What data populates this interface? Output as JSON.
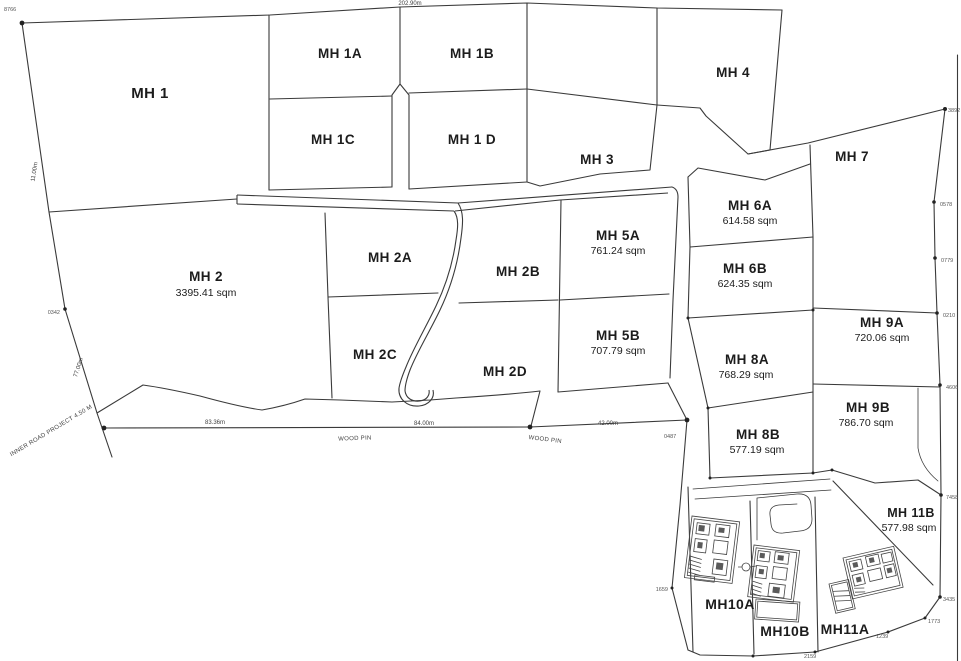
{
  "plots": [
    {
      "label": "MH 1"
    },
    {
      "label": "MH 1A"
    },
    {
      "label": "MH 1B"
    },
    {
      "label": "MH 1C"
    },
    {
      "label": "MH 1 D"
    },
    {
      "label": "MH 3"
    },
    {
      "label": "MH 4"
    },
    {
      "label": "MH 7"
    },
    {
      "label": "MH 2",
      "area": "3395.41 sqm"
    },
    {
      "label": "MH 2A"
    },
    {
      "label": "MH 2B"
    },
    {
      "label": "MH 2C"
    },
    {
      "label": "MH 2D"
    },
    {
      "label": "MH 5A",
      "area": "761.24 sqm"
    },
    {
      "label": "MH 5B",
      "area": "707.79 sqm"
    },
    {
      "label": "MH 6A",
      "area": "614.58 sqm"
    },
    {
      "label": "MH 6B",
      "area": "624.35 sqm"
    },
    {
      "label": "MH 8A",
      "area": "768.29 sqm"
    },
    {
      "label": "MH 8B",
      "area": "577.19 sqm"
    },
    {
      "label": "MH 9A",
      "area": "720.06 sqm"
    },
    {
      "label": "MH 9B",
      "area": "786.70 sqm"
    },
    {
      "label": "MH 11B",
      "area": "577.98 sqm"
    },
    {
      "label": "MH10A"
    },
    {
      "label": "MH10B"
    },
    {
      "label": "MH11A"
    }
  ],
  "dimensions": {
    "top_edge": "202.90m",
    "left_edge_upper": "11.00m",
    "left_edge_lower": "77.00m",
    "road_seg_1": "83.36m",
    "road_seg_2": "84.00m",
    "road_seg_3": "42.00m"
  },
  "road_labels": {
    "inner_road": "INNER ROAD PROJECT 4.50 M",
    "wood_pin_1": "WOOD PIN",
    "wood_pin_2": "WOOD PIN"
  },
  "survey_markers": [
    "8766",
    "0342",
    "3892",
    "0578",
    "0779",
    "0210",
    "4606",
    "7458",
    "3435",
    "1773",
    "1239",
    "2159",
    "1659",
    "0487"
  ],
  "colors": {
    "line": "#3a3a3a",
    "text": "#1c1c1c",
    "marker_text": "#555555",
    "background": "#ffffff"
  }
}
